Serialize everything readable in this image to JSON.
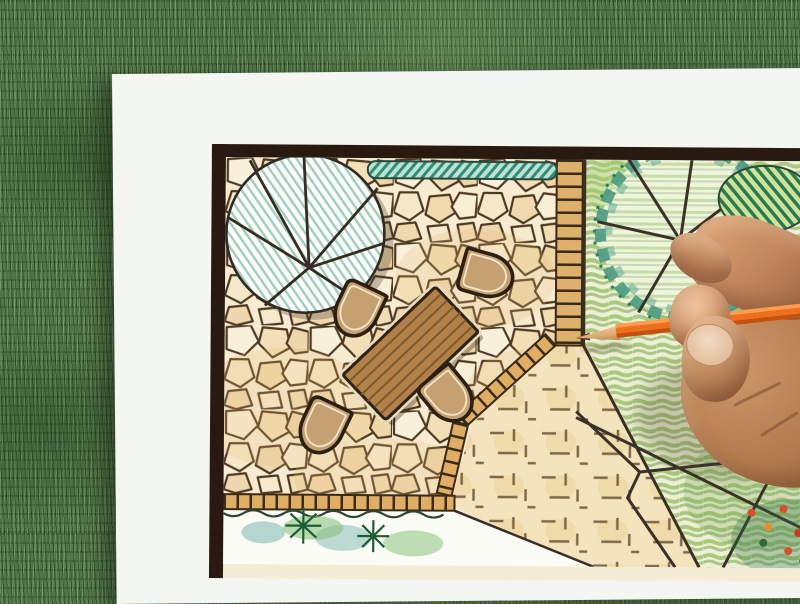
{
  "scene": {
    "type": "photograph",
    "subject": "hand-with-pencil-drawing-garden-landscape-plan",
    "elements": {
      "background": "artificial-grass",
      "sheet": "white-paper",
      "drawing": "garden-design-plan-with-dark-frame",
      "plan_features": [
        "tree-symbol-teal-hatched",
        "hedge-row",
        "flagstone-patio",
        "garden-table",
        "four-chairs",
        "tile-edging-bands",
        "gravel-area-dashes",
        "lawn-green-shading",
        "tree-symbol-right",
        "striped-shrub",
        "path-lines",
        "flower-bed",
        "planting-bed-with-conifers"
      ],
      "foreground": [
        "human-hand",
        "orange-colored-pencil"
      ]
    }
  },
  "colors": {
    "grass_base": "#517547",
    "paper": "#f4f6f2",
    "frame": "#281a10",
    "plan_line": "#3a2f24",
    "stone_bg": "#f7ecd2",
    "stone_outline": "#4d3820",
    "tile_orange": "#dfae64",
    "hedge_teal": "#2f8f73",
    "tree_hatch_teal": "#a3ccc0",
    "lawn_base": "#eef0d6",
    "lawn_green": "#9fc26f",
    "gravel_base": "#f3e4bd",
    "gravel_dash": "#6b5334",
    "table_brown": "#b28147",
    "chair_tan": "#c5a070",
    "tree_ring_teal": "#4a9982",
    "bush_green": "#2c7a52",
    "conifer_green": "#1e5c33",
    "flower_red": "#d84f2a",
    "skin_light": "#edc49c",
    "skin_mid": "#bb8058",
    "skin_deep": "#8d5a38",
    "pencil_orange": "#ee6f1e",
    "pencil_highlight": "#ff9d4e",
    "pencil_wood": "#dcab72",
    "pencil_lead": "#55402c"
  }
}
